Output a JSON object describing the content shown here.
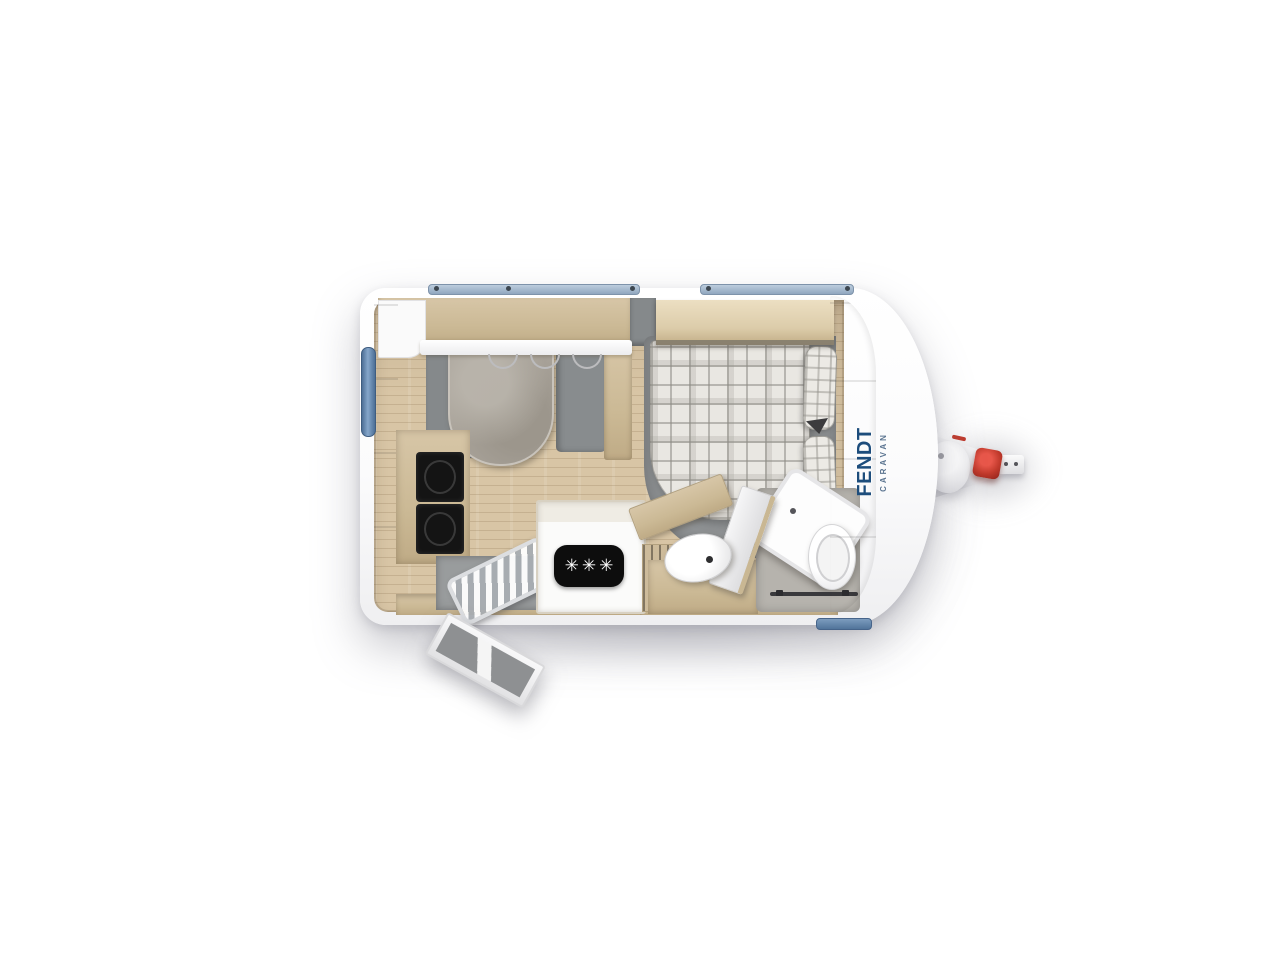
{
  "floorplan": {
    "title": "Fendt caravan floor plan (top view)",
    "brand": {
      "name": "FENDT",
      "sub": "CARAVAN",
      "logo_color": "#1d4d7c"
    },
    "fridge": {
      "symbol": "✳✳✳",
      "plate_color": "#0d0d0d",
      "symbol_color": "#ffffff"
    },
    "colors": {
      "body_white": "#ffffff",
      "cabinet_wood": "#cfbd9d",
      "floor_wood": "#d8c5a5",
      "cushion_gray": "#888c8e",
      "table_gray": "#a9a39a",
      "plaid_base": "#e9e7e2",
      "appliance_black": "#141414",
      "window_blue": "#6d90b4",
      "roof_window_blue": "#a5b9cd",
      "coupler_red": "#c0392b"
    },
    "fixtures": [
      "overhead-cabinets",
      "dinette-table",
      "dinette-seat-left",
      "dinette-seat-right",
      "kitchen-cooker",
      "refrigerator",
      "entry-mat",
      "entry-tray",
      "entry-door",
      "wardrobe",
      "washbasin",
      "bathroom-door",
      "shower-tray",
      "toilet",
      "double-bed",
      "bed-pillows",
      "bed-shelf",
      "front-cabinet",
      "window-rear",
      "roof-window-left",
      "roof-window-right",
      "window-front",
      "drawbar-hitch",
      "jockey-wheel-plate",
      "coupling-handle"
    ]
  }
}
